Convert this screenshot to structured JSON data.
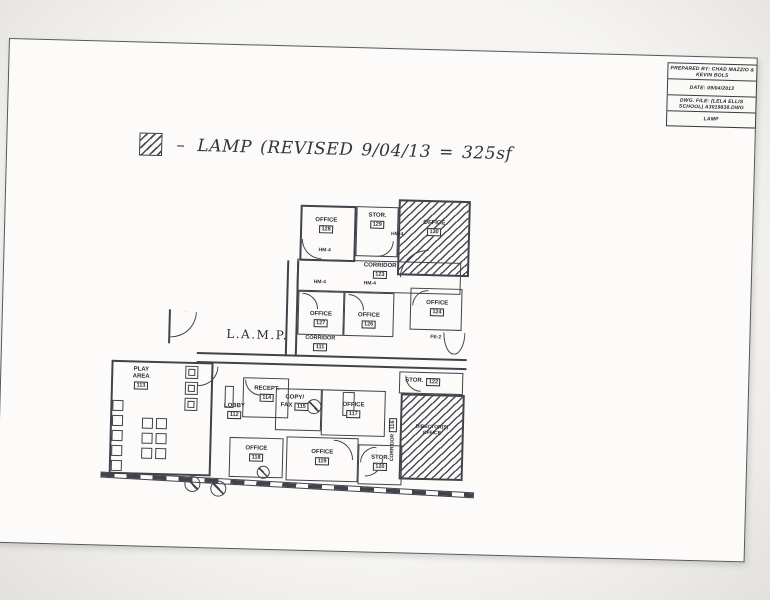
{
  "title_block": {
    "rows": [
      "PREPARED BY: CHAD MAZZIO & KEVIN BOLS",
      "DATE: 09/04/2013",
      "DWG. FILE: (LELA ELLIS SCHOOL) A3019838.DWG",
      "LAMP"
    ]
  },
  "legend": {
    "dash": "–",
    "text": "LAMP (REVISED 9/04/13 = 325sf"
  },
  "plan": {
    "main_label": "L.A.M.P.",
    "rooms": {
      "office_128": {
        "name": "OFFICE",
        "number": "128"
      },
      "stor_129": {
        "name": "STOR.",
        "number": "129"
      },
      "office_130": {
        "name": "OFFICE",
        "number": "130"
      },
      "corridor_123": {
        "name": "CORRIDOR",
        "number": "123"
      },
      "office_127": {
        "name": "OFFICE",
        "number": "127"
      },
      "office_126": {
        "name": "OFFICE",
        "number": "126"
      },
      "office_124": {
        "name": "OFFICE",
        "number": "124"
      },
      "corridor_111": {
        "name": "CORRIDOR",
        "number": "111"
      },
      "play_area_113": {
        "name": "PLAY\nAREA",
        "number": "113"
      },
      "lobby_112": {
        "name": "LOBBY",
        "number": "112"
      },
      "recept_114": {
        "name": "RECEPT.",
        "number": "114"
      },
      "copy_fax_115": {
        "line1": "COPY/",
        "line2": "FAX",
        "number": "115"
      },
      "office_117": {
        "name": "OFFICE",
        "number": "117"
      },
      "corridor_116": {
        "name": "CORRIDOR",
        "number": "116"
      },
      "stor_122": {
        "name": "STOR.",
        "number": "122"
      },
      "director": {
        "name": "DIRECTOR(S)\nOFFICE"
      },
      "office_118": {
        "name": "OFFICE",
        "number": "118"
      },
      "office_119": {
        "name": "OFFICE",
        "number": "119"
      },
      "stor_120": {
        "name": "STOR.",
        "number": "120"
      }
    },
    "tags": {
      "hm4": "HM-4",
      "fe2": "FE-2"
    }
  }
}
